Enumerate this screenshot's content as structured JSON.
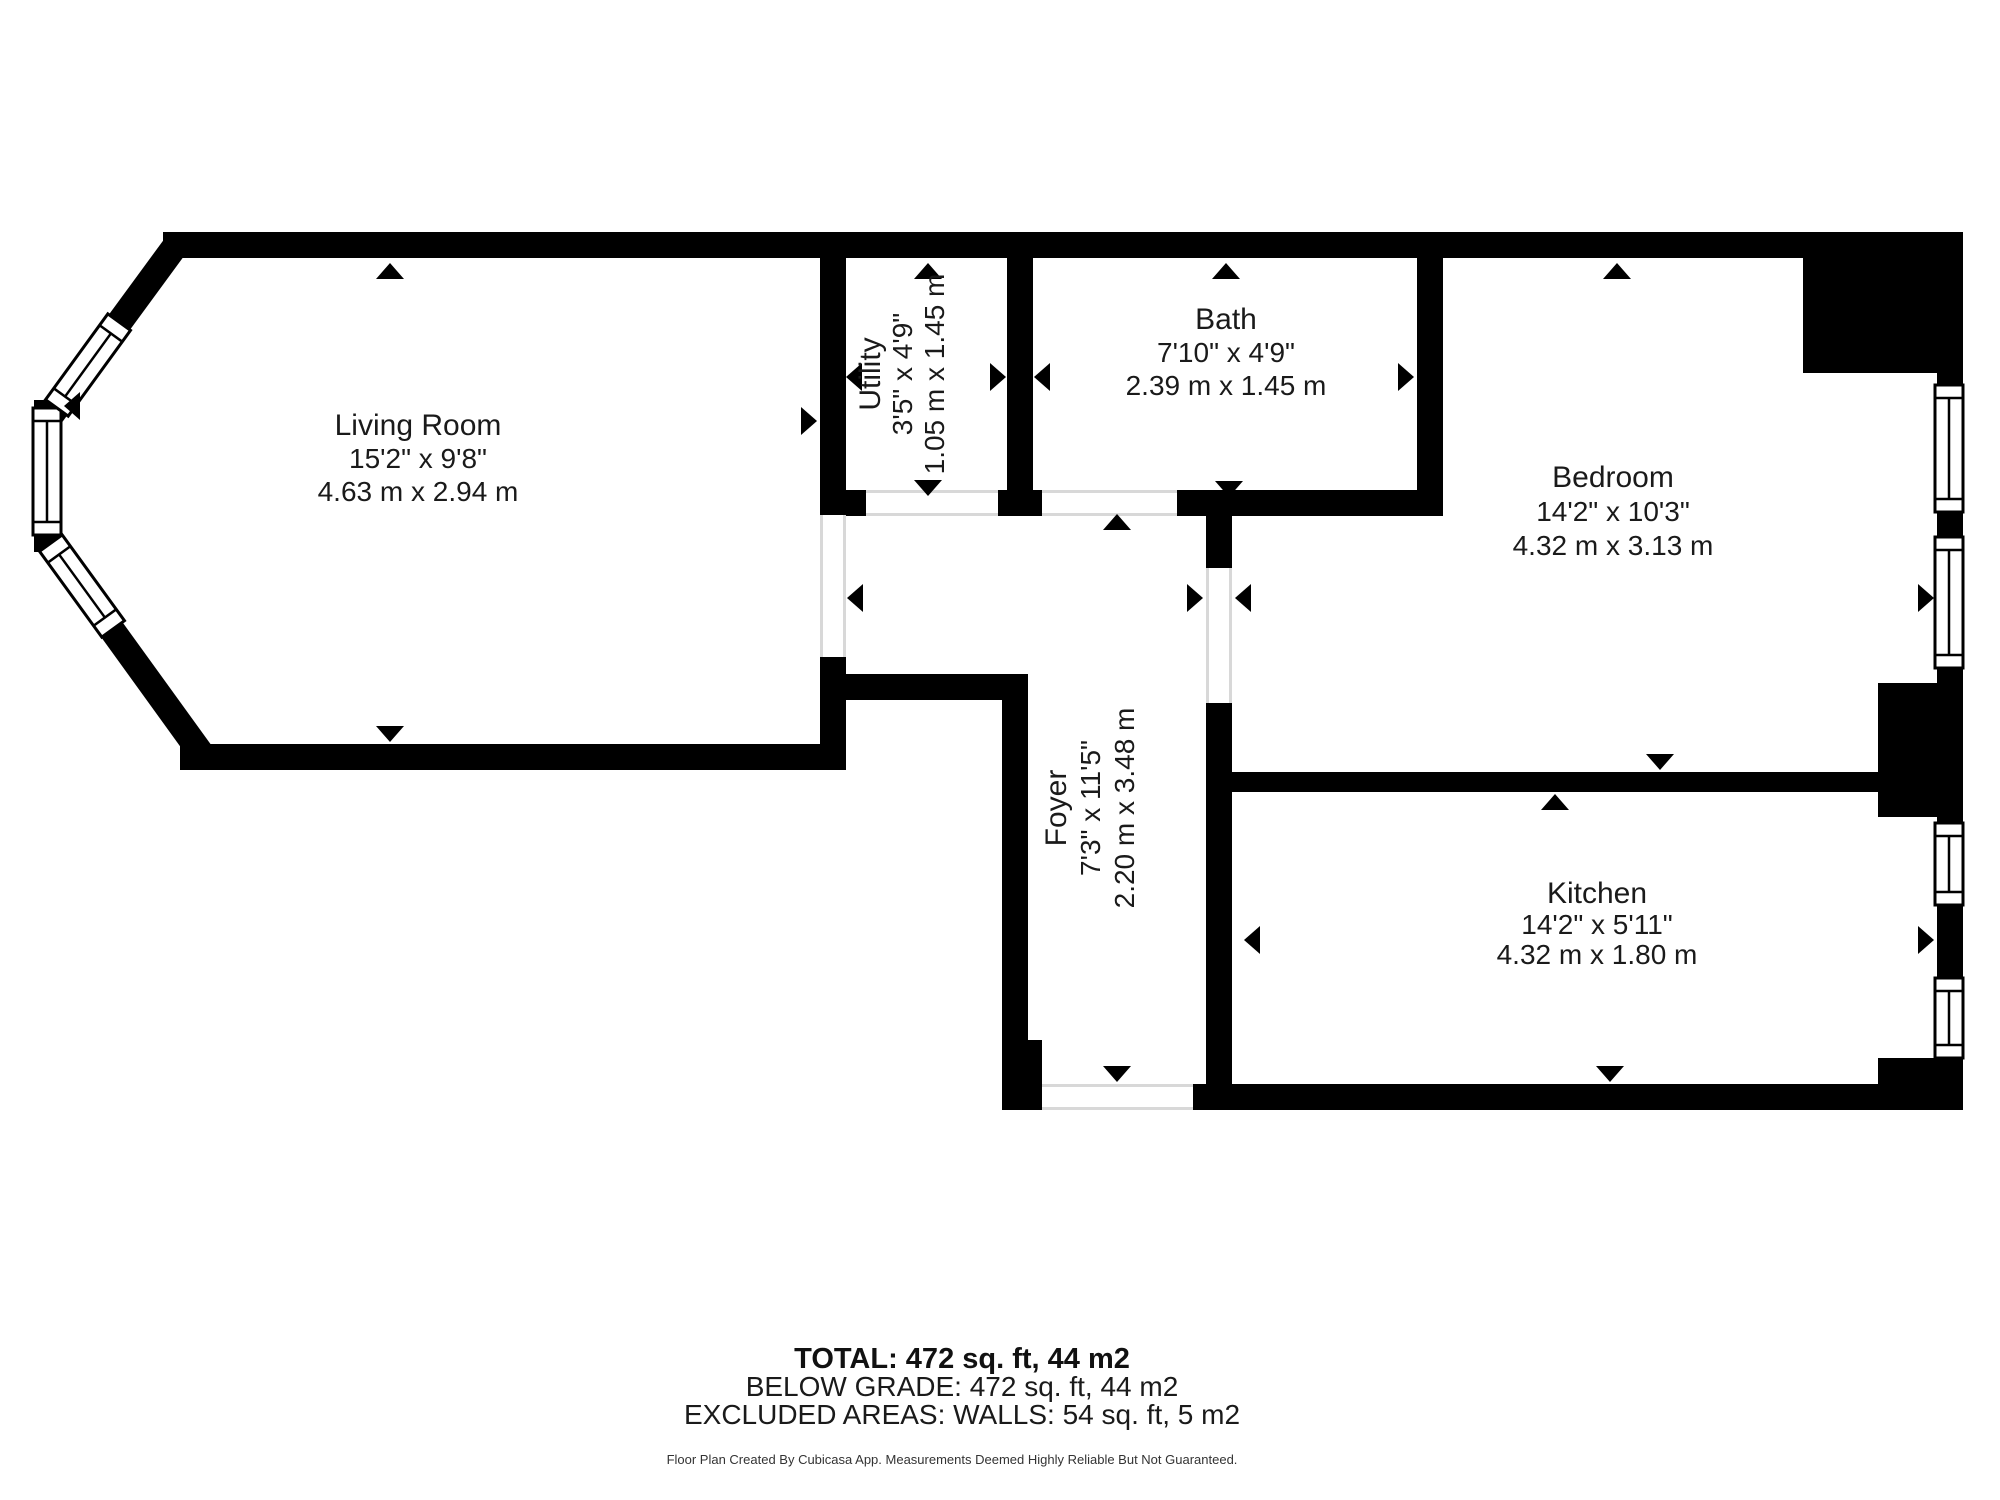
{
  "plan": {
    "rooms": [
      {
        "name": "Living Room",
        "dims_ft": "15'2\" x 9'8\"",
        "dims_m": "4.63 m x 2.94 m"
      },
      {
        "name": "Utility",
        "dims_ft": "3'5\" x 4'9\"",
        "dims_m": "1.05 m x 1.45 m"
      },
      {
        "name": "Bath",
        "dims_ft": "7'10\" x 4'9\"",
        "dims_m": "2.39 m x 1.45 m"
      },
      {
        "name": "Bedroom",
        "dims_ft": "14'2\" x 10'3\"",
        "dims_m": "4.32 m x 3.13 m"
      },
      {
        "name": "Foyer",
        "dims_ft": "7'3\" x 11'5\"",
        "dims_m": "2.20 m x 3.48 m"
      },
      {
        "name": "Kitchen",
        "dims_ft": "14'2\" x 5'11\"",
        "dims_m": "4.32 m x 1.80 m"
      }
    ],
    "summary": {
      "total": "TOTAL: 472 sq. ft, 44 m2",
      "below_grade": "BELOW GRADE: 472 sq. ft, 44 m2",
      "excluded": "EXCLUDED AREAS: WALLS: 54 sq. ft, 5 m2"
    },
    "footer": "Floor Plan Created By Cubicasa App. Measurements Deemed Highly Reliable But Not Guaranteed.",
    "colors": {
      "wall": "#000000",
      "text": "#1a1a1a",
      "opening_line": "#d8d8d8"
    }
  }
}
